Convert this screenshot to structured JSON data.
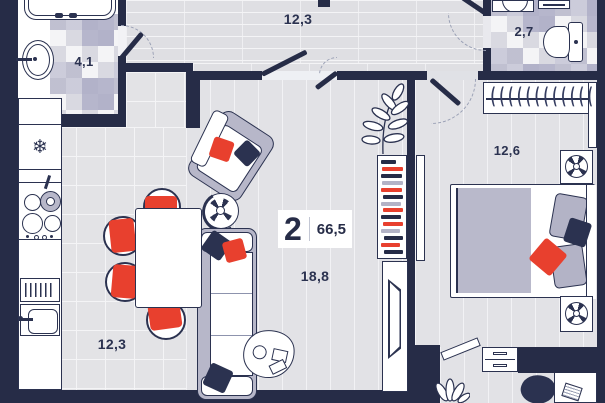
{
  "floorplan": {
    "badge": {
      "rooms_count": "2",
      "total_area": "66,5"
    },
    "rooms": {
      "bathroom": {
        "area": "4,1"
      },
      "hallway": {
        "area": "12,3"
      },
      "wc": {
        "area": "2,7"
      },
      "bedroom": {
        "area": "12,6"
      },
      "living": {
        "area": "18,8"
      },
      "kitchen": {
        "area": "12,3"
      }
    },
    "icons": {
      "fridge_snowflake": "❄",
      "wardrobe_hangers": "(((((((((((( ((("
    },
    "colors": {
      "wall": "#262c47",
      "floor": "#e3e3e6",
      "tile_accent": "#abacc4",
      "accent_red": "#e8402e",
      "accent_lavender": "#b7b7c9"
    },
    "bookshelf": [
      "#262c47",
      "#e8402e",
      "#262c47",
      "#b3b3c6",
      "#e8402e",
      "#262c47",
      "#b3b3c6",
      "#e8402e",
      "#262c47",
      "#e8402e",
      "#b3b3c6",
      "#262c47",
      "#e8402e",
      "#262c47"
    ]
  }
}
